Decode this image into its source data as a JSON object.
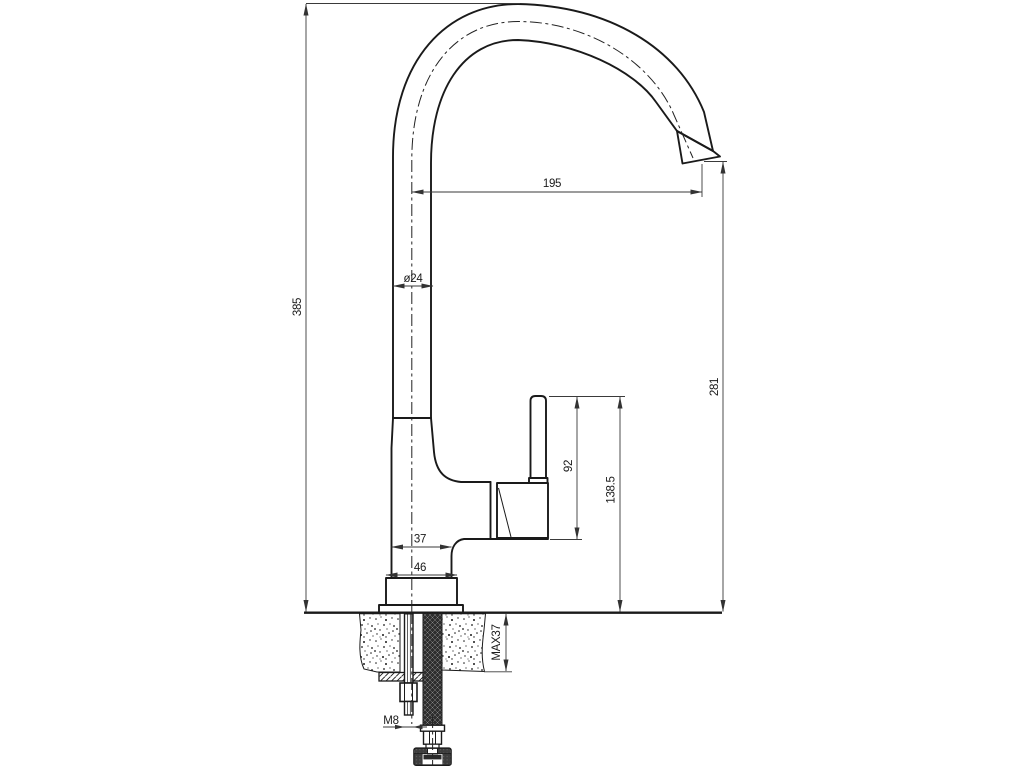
{
  "drawing": {
    "type": "technical-drawing-faucet-side-view",
    "line_color": "#1a1a1a",
    "background": "#ffffff",
    "dimensions": {
      "spout_reach": "195",
      "total_height": "385",
      "outlet_height": "281",
      "pipe_diameter": "ø24",
      "handle_top_to_body": "92",
      "handle_top_height": "138.5",
      "body_depth": "37",
      "base_width": "46",
      "max_mounting_thickness": "MAX37",
      "stud_thread": "M8"
    }
  }
}
